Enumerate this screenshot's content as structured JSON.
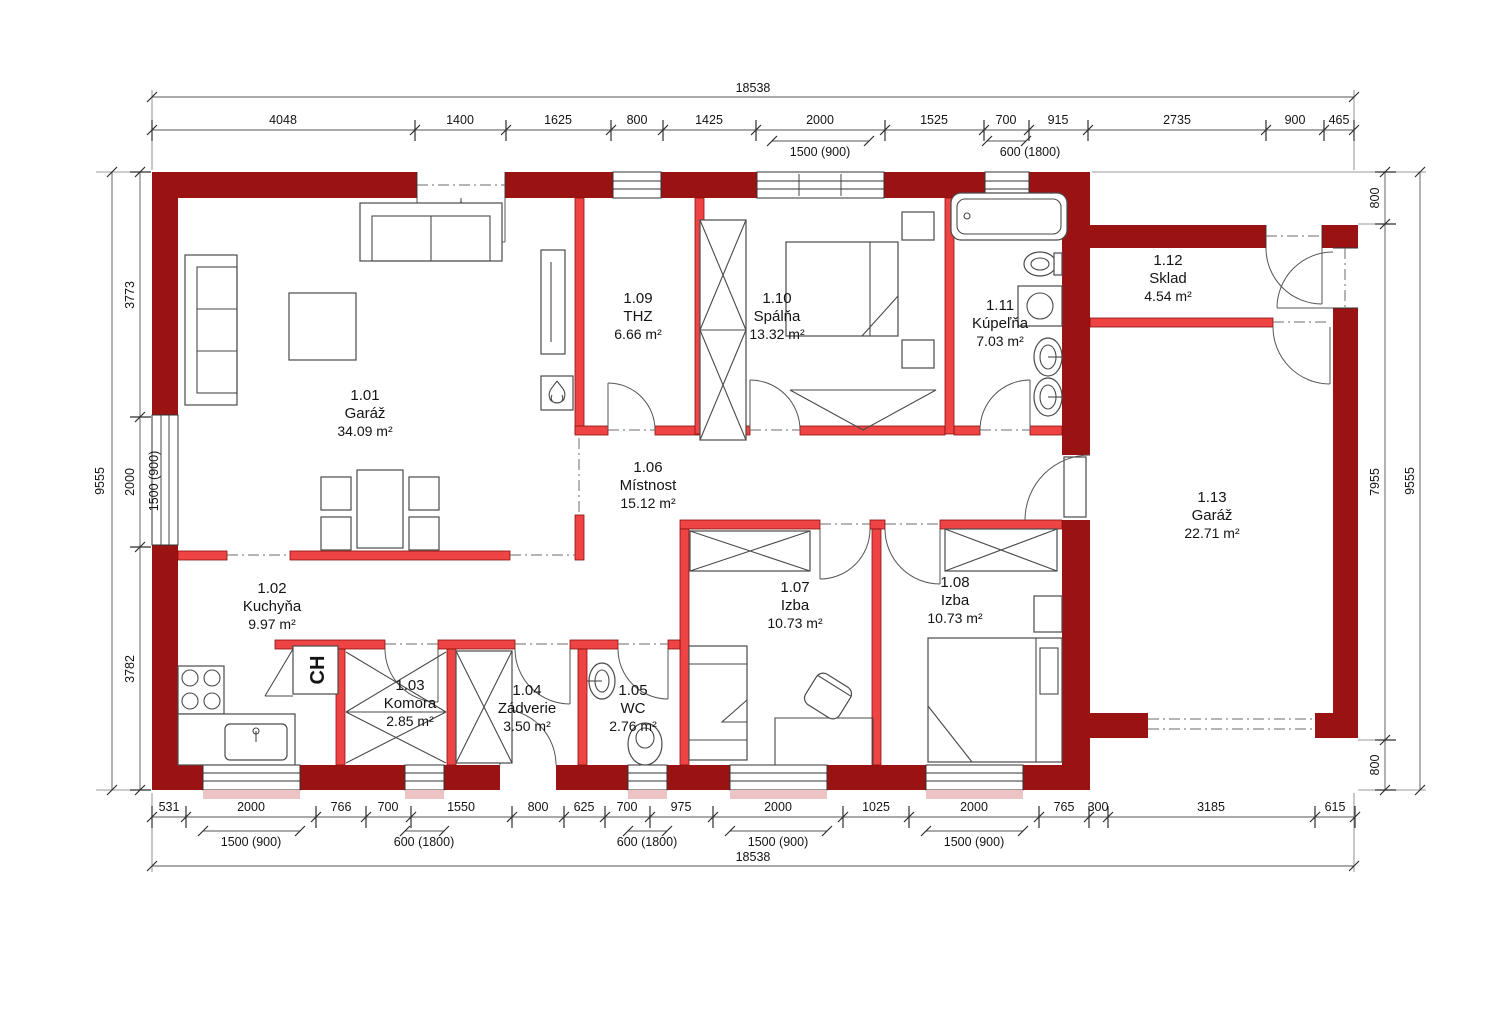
{
  "drawing": {
    "type": "floor-plan",
    "colors": {
      "outer_wall": "#9b1212",
      "inner_wall": "#ee4444",
      "lines": "#4a4a4a"
    }
  },
  "rooms": [
    {
      "number": "1.01",
      "name": "Garáž",
      "area": "34.09 m²"
    },
    {
      "number": "1.02",
      "name": "Kuchyňa",
      "area": "9.97 m²"
    },
    {
      "number": "1.03",
      "name": "Komora",
      "area": "2.85 m²"
    },
    {
      "number": "1.04",
      "name": "Zádverie",
      "area": "3.50 m²"
    },
    {
      "number": "1.05",
      "name": "WC",
      "area": "2.76 m²"
    },
    {
      "number": "1.06",
      "name": "Místnost",
      "area": "15.12 m²"
    },
    {
      "number": "1.07",
      "name": "Izba",
      "area": "10.73 m²"
    },
    {
      "number": "1.08",
      "name": "Izba",
      "area": "10.73 m²"
    },
    {
      "number": "1.09",
      "name": "THZ",
      "area": "6.66 m²"
    },
    {
      "number": "1.10",
      "name": "Spálňa",
      "area": "13.32 m²"
    },
    {
      "number": "1.11",
      "name": "Kúpeľňa",
      "area": "7.03 m²"
    },
    {
      "number": "1.12",
      "name": "Sklad",
      "area": "4.54 m²"
    },
    {
      "number": "1.13",
      "name": "Garáž",
      "area": "22.71 m²"
    }
  ],
  "labels": {
    "fridge": "CH"
  },
  "dimensions": {
    "top": {
      "total": "18538",
      "values": [
        "4048",
        "1400",
        "1625",
        "800",
        "1425",
        "2000",
        "1525",
        "700",
        "915",
        "2735",
        "900",
        "465"
      ],
      "sub": [
        "1500 (900)",
        "600 (1800)"
      ]
    },
    "bottom": {
      "total": "18538",
      "values": [
        "531",
        "2000",
        "766",
        "700",
        "1550",
        "800",
        "625",
        "700",
        "975",
        "2000",
        "1025",
        "2000",
        "765",
        "300",
        "3185",
        "615"
      ],
      "sub": [
        "1500 (900)",
        "600 (1800)",
        "600 (1800)",
        "1500 (900)",
        "1500 (900)"
      ]
    },
    "left": {
      "total": "9555",
      "values": [
        "3773",
        "2000",
        "3782"
      ],
      "sub": [
        "1500 (900)"
      ]
    },
    "right": {
      "total": "9555",
      "values": [
        "800",
        "7955",
        "800"
      ]
    }
  }
}
